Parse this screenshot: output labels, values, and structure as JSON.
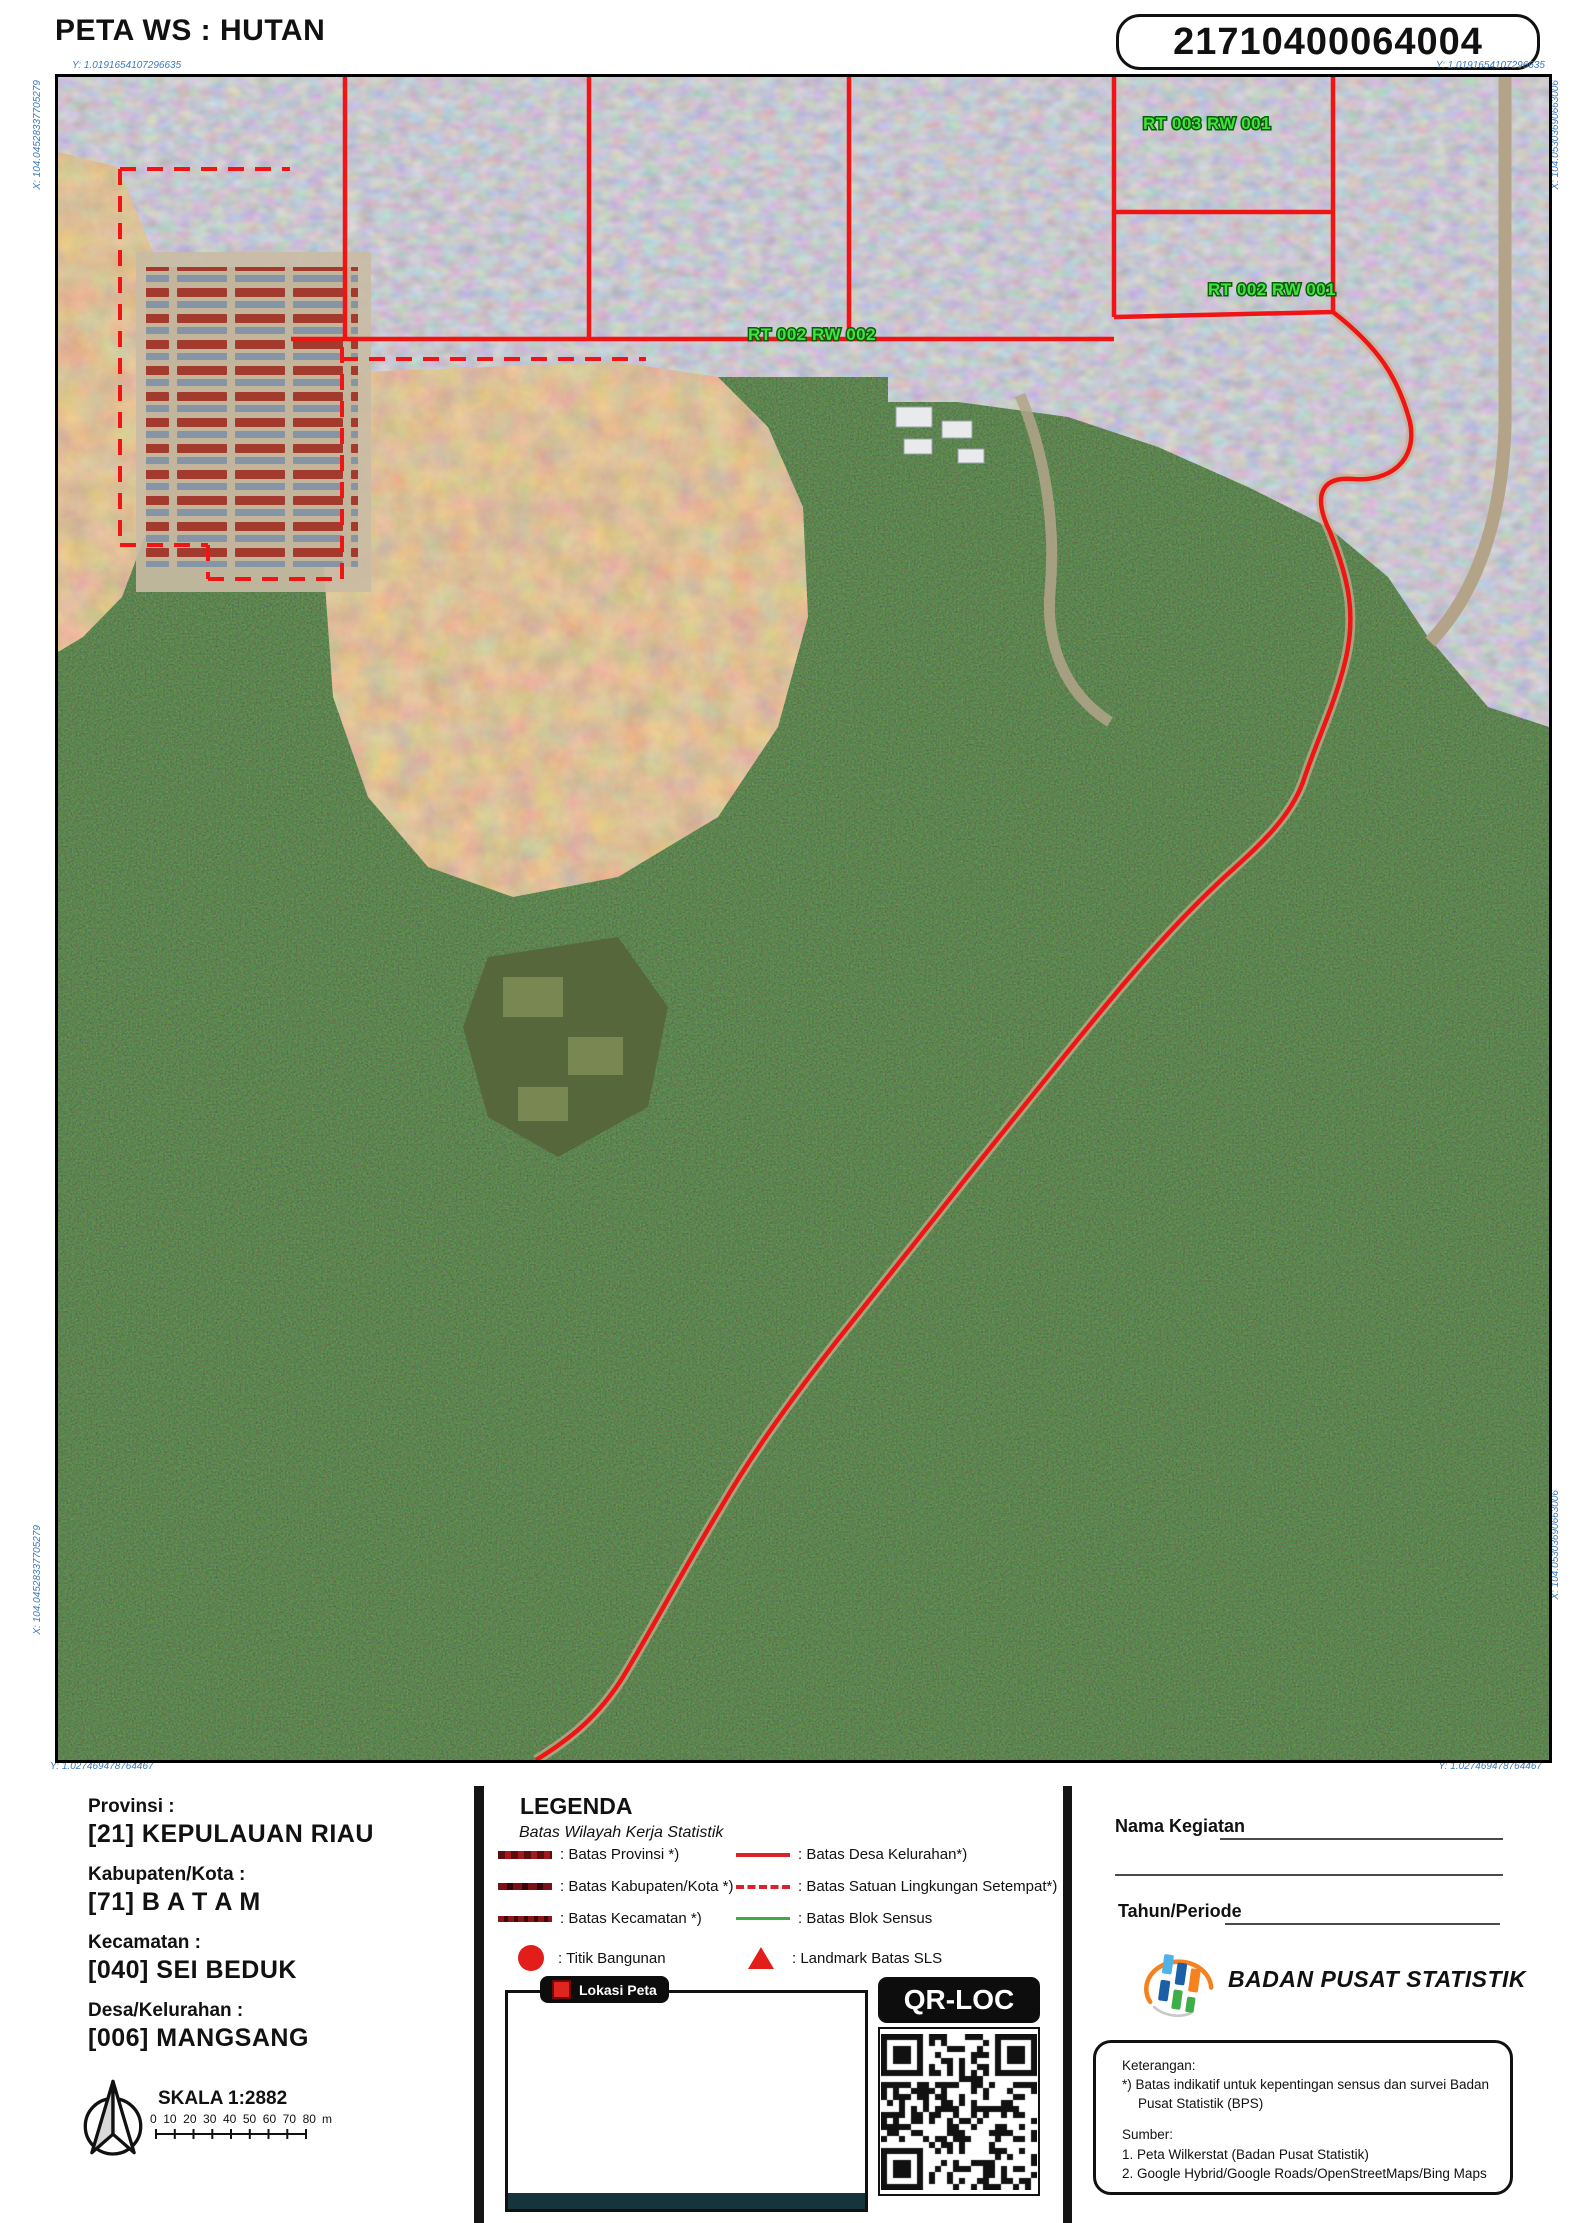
{
  "header": {
    "title": "PETA WS :  HUTAN",
    "map_id": "21710400064004"
  },
  "map": {
    "coordinates": {
      "top_left_y": "Y: 1.0191654107296635",
      "top_right_y": "Y: 1.0191654107296635",
      "bottom_left_y": "Y: 1.027469478764467",
      "bottom_right_y": "Y: 1.027469478764467",
      "left_x": "X: 104.04528337705279",
      "right_x": "X: 104.05303690663006"
    },
    "rt_labels": [
      "RT 003 RW 001",
      "RT 002 RW 001",
      "RT 002 RW 002"
    ]
  },
  "info": {
    "groups": [
      {
        "label": "Provinsi :",
        "value": "[21] KEPULAUAN RIAU"
      },
      {
        "label": "Kabupaten/Kota :",
        "value": "[71] B A T A M"
      },
      {
        "label": "Kecamatan :",
        "value": "[040] SEI BEDUK"
      },
      {
        "label": "Desa/Kelurahan :",
        "value": "[006] MANGSANG"
      }
    ],
    "scale": {
      "label": "SKALA 1:2882",
      "ticks": [
        "0",
        "10",
        "20",
        "30",
        "40",
        "50",
        "60",
        "70",
        "80"
      ],
      "unit": "m"
    }
  },
  "legend": {
    "title": "LEGENDA",
    "subtitle": "Batas Wilayah Kerja Statistik",
    "left_items": [
      {
        "label": ": Batas Provinsi *)"
      },
      {
        "label": ": Batas Kabupaten/Kota *)"
      },
      {
        "label": ": Batas Kecamatan *)"
      }
    ],
    "right_items": [
      {
        "label": ": Batas Desa Kelurahan*)"
      },
      {
        "label": ": Batas Satuan Lingkungan Setempat*)"
      },
      {
        "label": ": Batas Blok Sensus"
      }
    ],
    "point_items": [
      {
        "label": ": Titik Bangunan"
      },
      {
        "label": ": Landmark Batas SLS"
      }
    ],
    "inset_label": "Lokasi Peta",
    "qr_label": "QR-LOC"
  },
  "panel": {
    "nama_kegiatan_label": "Nama Kegiatan",
    "tahun_periode_label": "Tahun/Periode",
    "agency_name": "BADAN PUSAT STATISTIK",
    "notes": {
      "keterangan_title": "Keterangan:",
      "keterangan_line1": "*) Batas indikatif untuk kepentingan sensus dan survei Badan",
      "keterangan_line2": "Pusat Statistik (BPS)",
      "sumber_title": "Sumber:",
      "sumber_line1": "1. Peta Wilkerstat  (Badan Pusat Statistik)",
      "sumber_line2": "2. Google Hybrid/Google Roads/OpenStreetMaps/Bing Maps"
    }
  },
  "colors": {
    "boundary_red": "#f01414",
    "blok_sensus_green": "#3faa4a",
    "rt_label_green": "#3fe43f",
    "admin_maroon": "#7a1016",
    "coordinate_blue": "#3a7abd",
    "bps_blue": "#1b5fa6",
    "bps_lightblue": "#4fb3e6",
    "bps_green": "#3fae49",
    "bps_orange": "#f6821f"
  }
}
